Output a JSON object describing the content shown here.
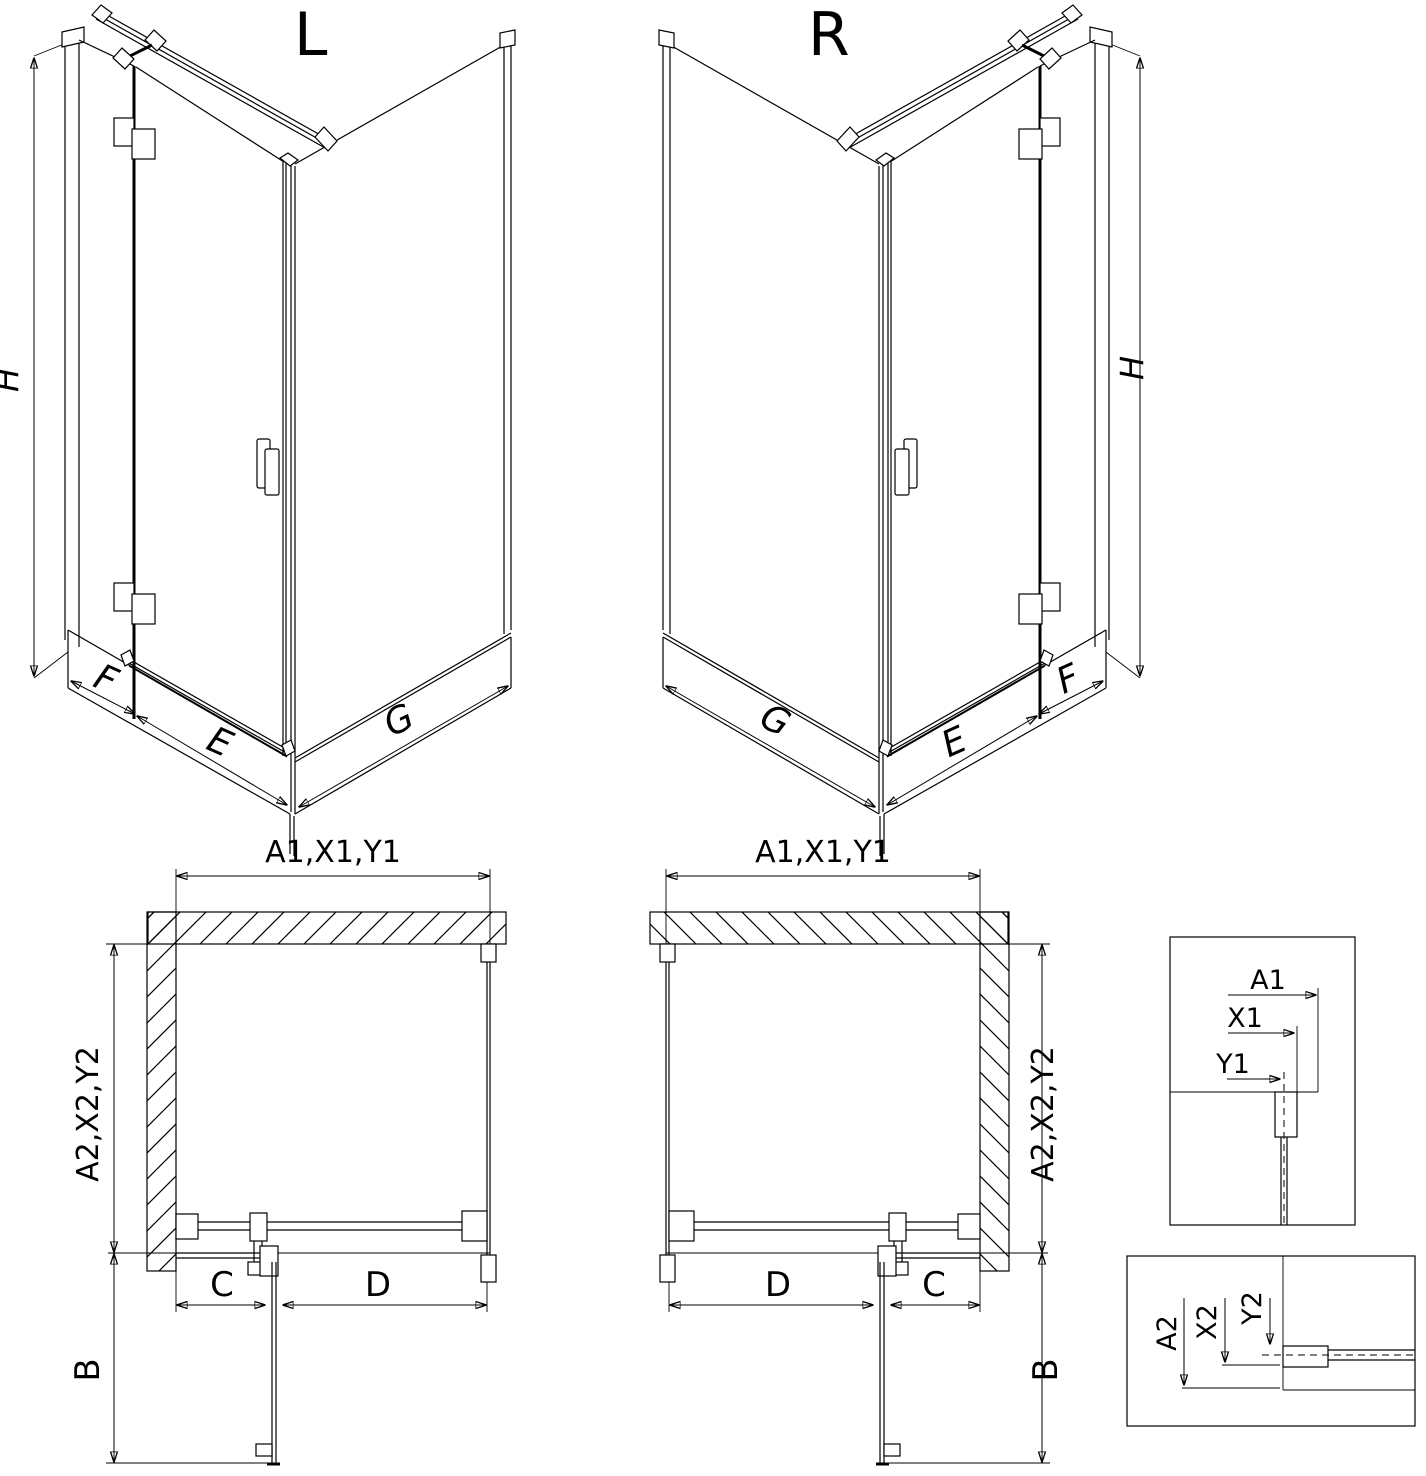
{
  "drawing": {
    "title": "shower enclosure dimension drawing",
    "colors": {
      "line": "#000000",
      "background": "#ffffff"
    },
    "views": {
      "iso_left": {
        "title": "L",
        "height_label": "H",
        "f": "F",
        "e": "E",
        "g": "G"
      },
      "iso_right": {
        "title": "R",
        "height_label": "H",
        "g": "G",
        "e": "E",
        "f": "F"
      },
      "plan_left": {
        "width_dim": "A1,X1,Y1",
        "depth_dim": "A2,X2,Y2",
        "c": "C",
        "d": "D",
        "b": "B"
      },
      "plan_right": {
        "width_dim": "A1,X1,Y1",
        "depth_dim": "A2,X2,Y2",
        "d": "D",
        "c": "C",
        "b": "B"
      },
      "detail_top": {
        "a1": "A1",
        "x1": "X1",
        "y1": "Y1"
      },
      "detail_bottom": {
        "a2": "A2",
        "x2": "X2",
        "y2": "Y2"
      }
    }
  }
}
